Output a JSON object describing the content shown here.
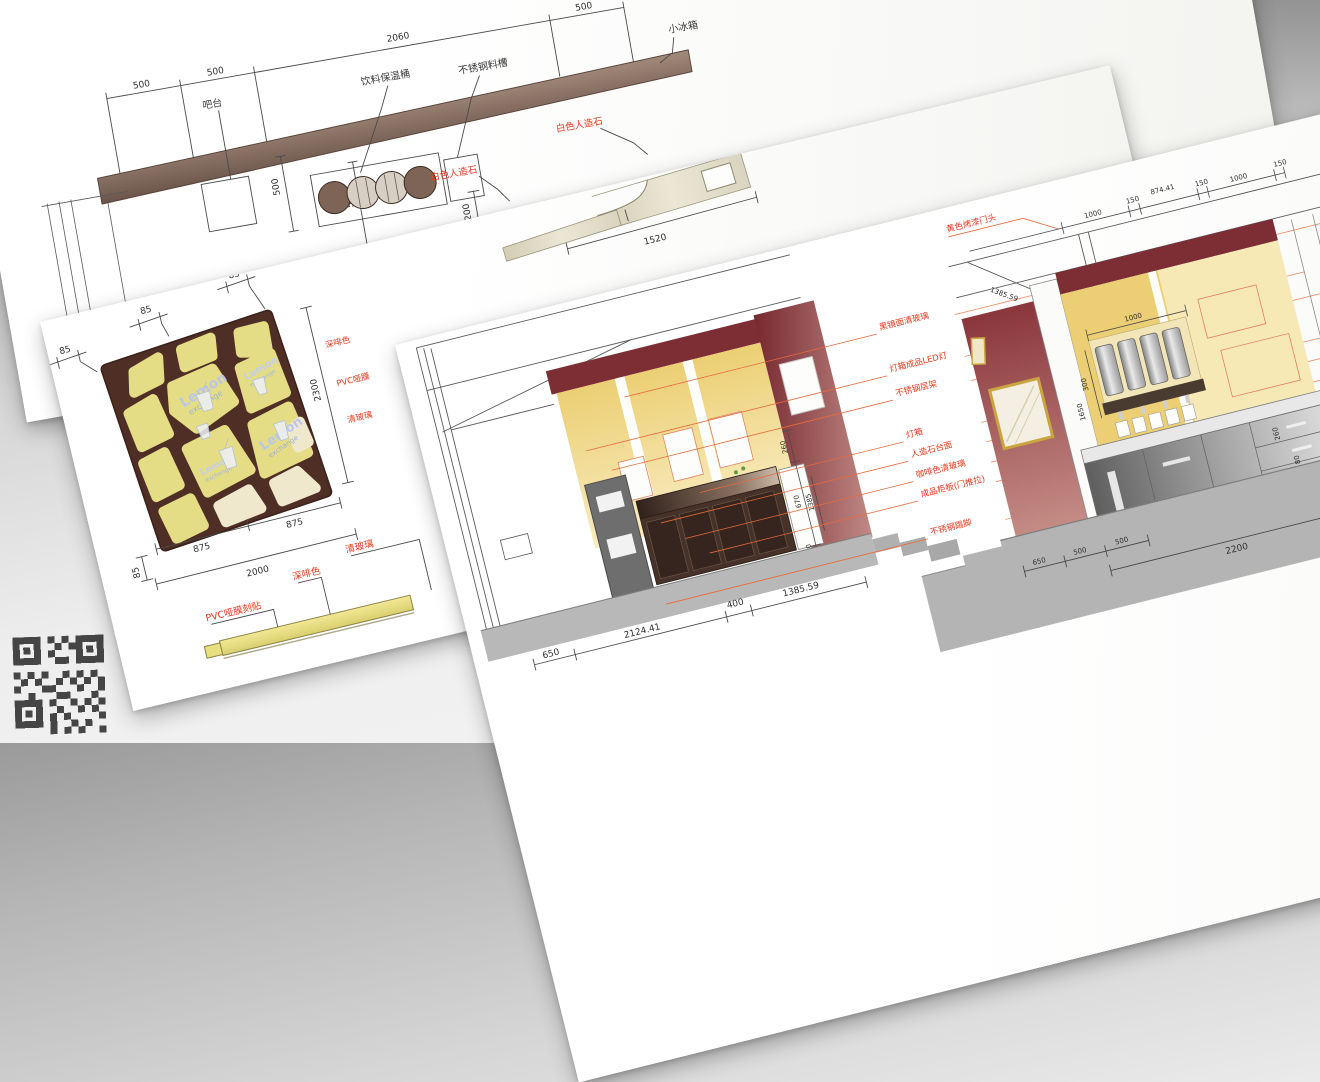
{
  "bar_plan": {
    "dim_500_a": "500",
    "dim_500_b": "500",
    "dim_2060": "2060",
    "dim_500_c": "500",
    "dim_500_v1": "500",
    "dim_500_v2": "500",
    "label_bar": "吧台",
    "label_warmer": "饮料保温桶",
    "label_trough": "不锈钢料槽",
    "label_fridge": "小冰箱",
    "label_stone_a": "白色人造石",
    "label_stone_b": "白色人造石",
    "dim_200": "200"
  },
  "countertop": {
    "dim_1520": "1520"
  },
  "panel": {
    "dim_85_a": "85",
    "dim_85_b": "85",
    "dim_85_c": "85",
    "dim_85_v": "85",
    "dim_2300": "2300",
    "dim_875_a": "875",
    "dim_875_b": "875",
    "dim_2000": "2000",
    "logo_line1": "Lemon",
    "logo_line2": "exchange",
    "side_label_a": "深啡色",
    "side_label_b": "PVC哑膜",
    "side_label_c": "清玻璃"
  },
  "strip": {
    "label_pvc": "PVC哑膜刻贴",
    "label_dark": "深啡色",
    "label_glass": "清玻璃"
  },
  "elevations": {
    "header_label": "黄色烤漆门头",
    "annotations": [
      "黑镜面清玻璃",
      "灯箱成品LED灯",
      "不锈钢层架",
      "灯箱",
      "人造石台面",
      "咖啡色清玻璃",
      "成品柜板(门推拉)",
      "不锈钢踢脚"
    ],
    "elev_a_side_dims": [
      "260",
      "670",
      "1385",
      "80"
    ],
    "elev_a_bottom_dims": [
      "650",
      "2124.41",
      "400",
      "1385.59"
    ],
    "elev_b_slope_dim": "1385.59",
    "elev_b_top_dims": [
      "1000",
      "150",
      "874.41",
      "150",
      "1000",
      "150"
    ],
    "elev_b_dims": {
      "d1000_disp": "1000",
      "d300": "300",
      "d1650": "1650",
      "d2300": "2300",
      "d1000_counter": "1000",
      "d260": "260",
      "d80": "80",
      "d20": "20"
    },
    "elev_b_bottom_dims": [
      "650",
      "500",
      "500",
      "2200",
      "500"
    ]
  },
  "colors": {
    "annotation_red": "#e8391c",
    "leader_orange": "#f08a60",
    "maroon_wall": "#7c2e34",
    "yellow_wall": "#eed27b",
    "panel_brown": "#4e2e25",
    "panel_cell": "#e5dd85",
    "counter_stone": "#e7e3d0",
    "band_brown": "#84695a",
    "stainless": "#9a9a9a"
  }
}
